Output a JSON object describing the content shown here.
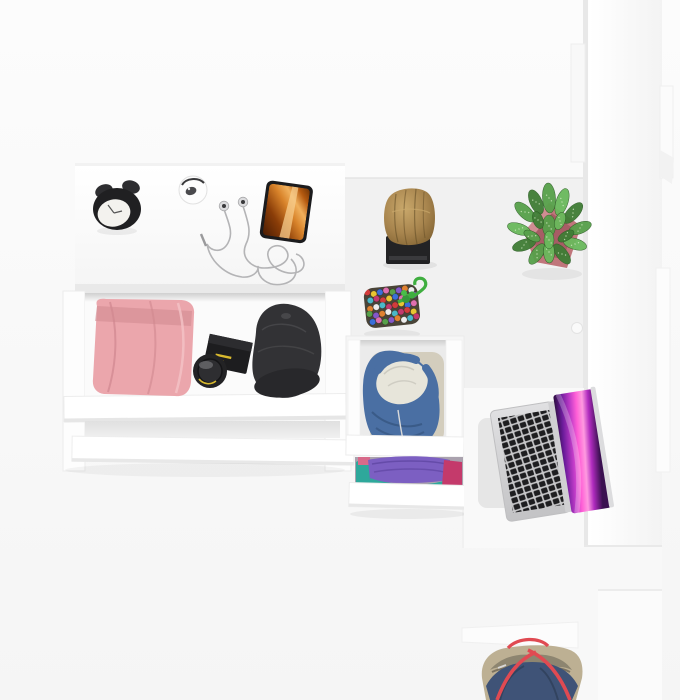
{
  "scene": {
    "title": "Top-down 3D render of a white bedroom furniture set: desk with open drawer of clothes and accessories, log stool, succulent in pink planter, chest drawers with denim jacket and folded shirts, tall white wardrobe, open laptop on desk and a navy tote bag",
    "objects": [
      {
        "name": "desk-with-open-drawer",
        "description": "White desk top-left with open clothes drawer and two pulled-out drawer fronts"
      },
      {
        "name": "alarm-clock",
        "description": "Black twin-bell alarm clock with white face"
      },
      {
        "name": "mini-clock",
        "description": "Small round white clock with dark arc"
      },
      {
        "name": "earbuds",
        "description": "Silver wired earbuds with tangled cable and plug"
      },
      {
        "name": "smartphone",
        "description": "Smartphone showing orange canyon wallpaper"
      },
      {
        "name": "pink-trousers",
        "description": "Folded pink trousers inside open drawer"
      },
      {
        "name": "camera-lens-box",
        "description": "Black lens box with yellow print"
      },
      {
        "name": "camera-lens",
        "description": "Round black camera lens"
      },
      {
        "name": "black-cap",
        "description": "Black cadet cap"
      },
      {
        "name": "wooden-stool",
        "description": "Natural log stool on black base"
      },
      {
        "name": "potted-succulent",
        "description": "Speckled green succulent in pink square planter"
      },
      {
        "name": "beaded-pouch",
        "description": "Multicolour beaded pouch with green cord and knot"
      },
      {
        "name": "drawer-denim",
        "description": "Open chest drawer with blue denim jacket, fleece lining and khaki garment"
      },
      {
        "name": "drawer-clothes",
        "description": "Half-open drawer with purple, teal and magenta folded clothes"
      },
      {
        "name": "wardrobe",
        "description": "Tall white wardrobe column on the right"
      },
      {
        "name": "laptop",
        "description": "Open silver laptop, black keys, magenta-purple wallpaper"
      },
      {
        "name": "desk-mat",
        "description": "Light gray mat beside laptop"
      },
      {
        "name": "tote-bag",
        "description": "Navy tote bag with beige trim and red handles at bottom right"
      }
    ]
  },
  "colors": {
    "background_top": "#fcfcfc",
    "background_bottom": "#f5f5f5",
    "furniture_white": "#ffffff",
    "edge_gray": "#e9e9e9",
    "floor_gray": "#f1f1f1",
    "clock_black": "#202022",
    "clock_face": "#f3f2ee",
    "mini_clock_white": "#fdfdfd",
    "earbud_silver": "#dcdcde",
    "cable_gray": "#b4b4b6",
    "phone_black": "#1b1b1d",
    "canyon_orange": "#d8832a",
    "wood_brown": "#a8854e",
    "wood_dark": "#5f4a24",
    "stool_base_black": "#232325",
    "pot_pink": "#c0767b",
    "pot_dark": "#9f565d",
    "plant_greens": [
      "#57a04a",
      "#3f7d35",
      "#6ab95c"
    ],
    "plant_speckle": "#d8ecc8",
    "pants_pink": "#eba6ac",
    "pants_shadow": "#d08890",
    "cap_black": "#323235",
    "cap_brim": "#28282b",
    "lens_black": "#1d1d1f",
    "lens_yellow": "#d8b92e",
    "bead_colors": [
      "#d23c3c",
      "#e8c532",
      "#3a6fd8",
      "#e06fb0",
      "#57a04a",
      "#8458c9",
      "#e08232",
      "#ededed",
      "#4ab8c9",
      "#c23a6e"
    ],
    "cord_green": "#3fae3f",
    "denim_blue": "#4a6fa3",
    "denim_shadow": "#33527c",
    "fleece_white": "#e7e5da",
    "khaki": "#d3cdbd",
    "tshirt_purple": "#7c5fc2",
    "tshirt_teal": "#2ea89b",
    "tshirt_magenta": "#c43a6b",
    "laptop_silver": "#d4d4d6",
    "key_black": "#1e1e20",
    "screen_magenta": "#ff5fd6",
    "mat_gray": "#e3e3e3",
    "bag_navy": "#3f5377",
    "bag_beige": "#bdb093",
    "bag_interior": "#8d8570",
    "bag_red": "#e04a52"
  }
}
